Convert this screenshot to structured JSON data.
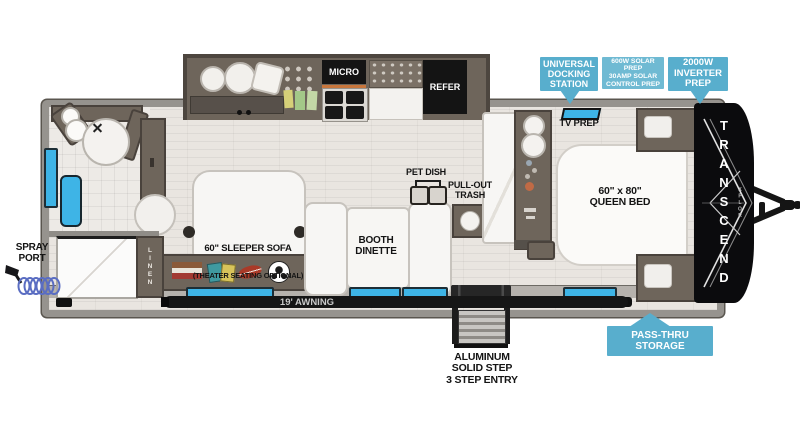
{
  "branding": {
    "model": "TRANSCEND",
    "series": "XPLOR"
  },
  "callouts": {
    "universal_docking": "UNIVERSAL\nDOCKING\nSTATION",
    "solar_prep": "600W SOLAR PREP\n30AMP SOLAR\nCONTROL PREP",
    "inverter_prep": "2000W\nINVERTER\nPREP",
    "pass_thru_storage": "PASS-THRU\nSTORAGE"
  },
  "labels": {
    "micro": "MICRO",
    "refer": "REFER",
    "tv_prep": "TV PREP",
    "pet_dish": "PET DISH",
    "pull_out_trash": "PULL-OUT\nTRASH",
    "queen_bed": "60\" x 80\"\nQUEEN BED",
    "booth_dinette": "BOOTH\nDINETTE",
    "sleeper_sofa": "60\" SLEEPER SOFA",
    "sleeper_sofa_option": "(THEATER SEATING OPTIONAL)",
    "linen": "LINEN",
    "spray_port": "SPRAY\nPORT",
    "awning": "19' AWNING",
    "entry_steps": "ALUMINUM\nSOLID STEP\n3 STEP ENTRY"
  },
  "colors": {
    "callout_blue": "#58aecd",
    "window_blue": "#3eb4e6",
    "cap_black": "#0b0b0d",
    "cabinet_taupe": "#6e655b"
  }
}
